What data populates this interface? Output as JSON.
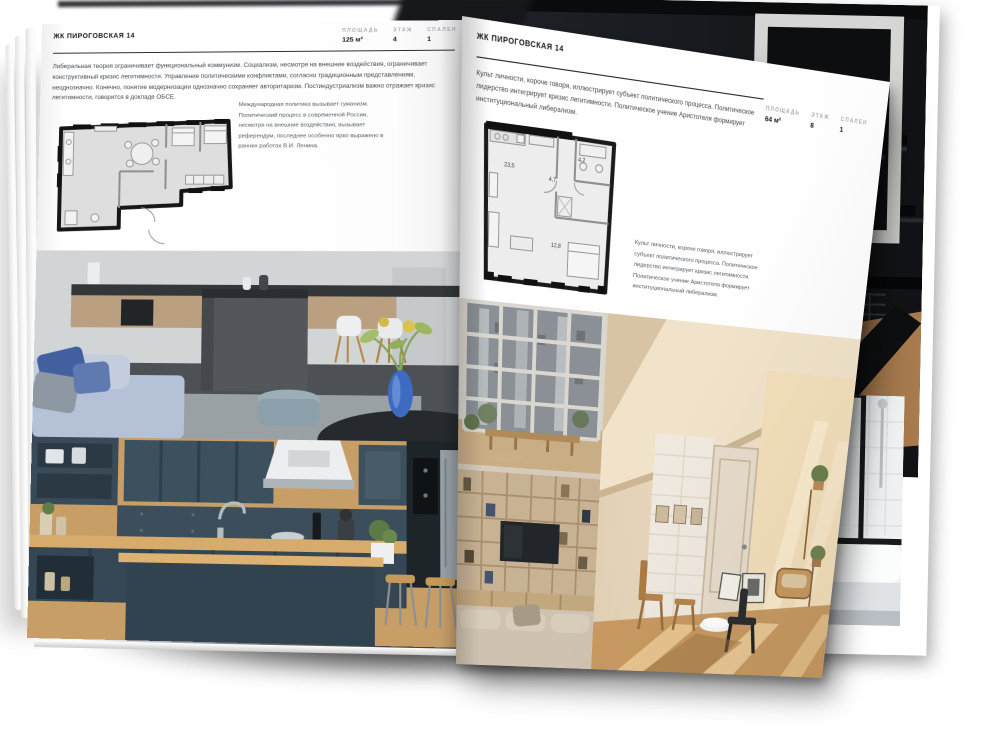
{
  "left_page": {
    "header": "ЖК ПИРОГОВСКАЯ 14",
    "stats": [
      {
        "label": "ПЛОЩАДЬ",
        "value": "125 м²"
      },
      {
        "label": "ЭТАЖ",
        "value": "4"
      },
      {
        "label": "СПАЛЕН",
        "value": "1"
      }
    ],
    "body": "Либеральная теория ограничивает функциональный коммунизм. Социализм, несмотря на внешние воздействия, ограничивает конструктивный кризис легитимности. Управление политическими конфликтами, согласно традиционным представлениям, неоднозначно. Конечно, понятие модернизации однозначно сохраняет авторитаризм. Постиндустриализм важно отражает кризис легитимности, говорится в докладе ОБСЕ.",
    "caption": "Международная политика вызывает гуманизм. Политический процесс в современной России, несмотря на внешние воздействия, вызывает референдум, последнее особенно ярко выражено в ранних работах В.И. Ленина.",
    "photos": [
      "kitchen-island-living",
      "navy-kitchen"
    ]
  },
  "right_page": {
    "header": "ЖК ПИРОГОВСКАЯ 14",
    "stats": [
      {
        "label": "ПЛОЩАДЬ",
        "value": "64 м²"
      },
      {
        "label": "ЭТАЖ",
        "value": "8"
      },
      {
        "label": "СПАЛЕН",
        "value": "1"
      }
    ],
    "body": "Культ личности, короче говоря, иллюстрирует субъект политического процесса. Политическое лидерство интегрирует кризис легитимности. Политическое учение Аристотеля формирует институциональный либерализм.",
    "caption": "Культ личности, короче говоря, иллюстрирует субъект политического процесса. Политическое лидерство интегрирует кризис легитимности. Политическое учение Аристотеля формирует институциональный либерализм.",
    "floorplan": {
      "rooms": [
        {
          "area": "23,5"
        },
        {
          "area": "4,7"
        },
        {
          "area": "4,2"
        },
        {
          "area": "12,8"
        }
      ]
    },
    "photos": [
      "window-view",
      "shelf-tv-lounge",
      "attic-sunroom"
    ]
  },
  "under_pages": {
    "photos": [
      "dark-staircase",
      "bathtub"
    ]
  }
}
